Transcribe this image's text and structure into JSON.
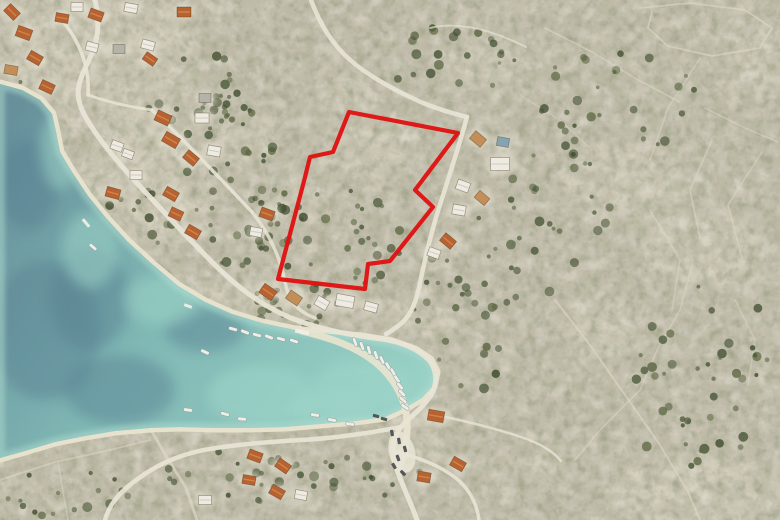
{
  "meta": {
    "description": "Aerial satellite photo of a coastal village and bay with a building plot outlined in red on a scrub hillside",
    "width": 780,
    "height": 520
  },
  "colors": {
    "land_base": "#c5bfae",
    "rock_light": "#d9d3c2",
    "veg_olive": "#6b6a4a",
    "veg_dark": "#3e452b",
    "tree": [
      "#42502f",
      "#55603a",
      "#384626"
    ],
    "sand": "#ece5d0",
    "water_deep": "#52828f",
    "water_mid": "#6fb0ad",
    "water_shallow": "#8fcfc2",
    "water_dark_patch": "#3e6a80",
    "water_light_patch": "#94d4c6",
    "shallow_rim": "#a7dccd",
    "road": "#ebe6d7",
    "wall": "#ded9c7",
    "yard": "#e8e3d3",
    "roof_orange": "#b65a25",
    "roof_orange_hl": "#d28445",
    "roof_tan": "#c08a52",
    "roof_white": "#f0eee5",
    "roof_gray": "#b3b1a8",
    "roof_blue": "#7fa0b2",
    "boat": "#f2f1e9",
    "car_dark": "#3c4046",
    "parcel_red": "#e01212"
  },
  "parcel": {
    "stroke_width": 4.2,
    "points": [
      [
        349,
        112
      ],
      [
        458,
        133
      ],
      [
        415,
        190
      ],
      [
        433,
        207
      ],
      [
        390,
        261
      ],
      [
        368,
        264
      ],
      [
        365,
        289
      ],
      [
        278,
        279
      ],
      [
        303,
        185
      ],
      [
        310,
        157
      ],
      [
        333,
        152
      ]
    ]
  },
  "water": {
    "points": [
      [
        0,
        84
      ],
      [
        22,
        90
      ],
      [
        40,
        100
      ],
      [
        52,
        114
      ],
      [
        56,
        132
      ],
      [
        60,
        152
      ],
      [
        72,
        172
      ],
      [
        88,
        196
      ],
      [
        106,
        218
      ],
      [
        128,
        242
      ],
      [
        152,
        264
      ],
      [
        178,
        286
      ],
      [
        205,
        302
      ],
      [
        232,
        314
      ],
      [
        262,
        323
      ],
      [
        295,
        330
      ],
      [
        330,
        334
      ],
      [
        362,
        337
      ],
      [
        392,
        342
      ],
      [
        415,
        350
      ],
      [
        430,
        360
      ],
      [
        436,
        372
      ],
      [
        433,
        386
      ],
      [
        422,
        398
      ],
      [
        405,
        408
      ],
      [
        385,
        417
      ],
      [
        355,
        421
      ],
      [
        320,
        424
      ],
      [
        285,
        427
      ],
      [
        250,
        428
      ],
      [
        215,
        428
      ],
      [
        180,
        427
      ],
      [
        150,
        428
      ],
      [
        115,
        431
      ],
      [
        85,
        436
      ],
      [
        55,
        442
      ],
      [
        25,
        451
      ],
      [
        0,
        458
      ]
    ],
    "dark_patches": [
      [
        45,
        330,
        55,
        70
      ],
      [
        120,
        390,
        55,
        35
      ],
      [
        28,
        185,
        30,
        45
      ],
      [
        205,
        330,
        40,
        22
      ],
      [
        90,
        300,
        40,
        50
      ]
    ],
    "light_patches": [
      [
        90,
        250,
        28,
        38
      ],
      [
        162,
        300,
        38,
        26
      ],
      [
        360,
        385,
        48,
        26
      ],
      [
        262,
        395,
        55,
        30
      ],
      [
        60,
        150,
        20,
        40
      ],
      [
        330,
        410,
        40,
        18
      ]
    ]
  },
  "roads": [
    {
      "d": "M95,0 C100,24 99,40 88,62 C77,84 74,96 85,116 C96,136 114,158 136,182 C160,208 186,236 212,262 C240,290 263,306 291,318 C321,330 351,335 381,339 C403,342 419,350 429,360 C437,370 438,383 431,395 C423,408 410,417 401,427 C392,438 391,452 396,467 C402,485 411,503 417,520",
      "w": 5,
      "o": 0.95
    },
    {
      "d": "M467,117 C459,146 448,180 438,211 C430,237 424,263 419,288 C415,306 409,318 398,326 C394,329 390,332 386,334",
      "w": 4.5,
      "o": 0.92
    },
    {
      "d": "M311,0 C319,22 331,43 349,59 C369,77 396,91 423,103 C440,110 455,114 467,117",
      "w": 4.5,
      "o": 0.9
    },
    {
      "d": "M401,427 C375,432 340,438 301,440 C266,442 241,444 216,448 C186,452 161,462 139,478 C119,492 109,505 105,520",
      "w": 4.5,
      "o": 0.92
    },
    {
      "d": "M396,452 C418,457 441,466 457,479 C471,491 477,505 479,520",
      "w": 3.5,
      "o": 0.9
    },
    {
      "d": "M431,414 C456,419 491,427 521,437 C539,443 553,451 561,461",
      "w": 2.5,
      "o": 0.8
    },
    {
      "d": "M62,20 C80,42 90,68 88,95",
      "w": 3.5,
      "o": 0.9
    },
    {
      "d": "M88,95 C108,102 130,107 152,110",
      "w": 3,
      "o": 0.85
    },
    {
      "d": "M152,110 C178,134 214,172 252,212",
      "w": 3.5,
      "o": 0.9
    },
    {
      "d": "M252,212 C268,232 280,256 285,282 C288,300 298,312 315,318",
      "w": 3.5,
      "o": 0.85
    },
    {
      "d": "M430,28 C462,20 498,33 526,47",
      "w": 2,
      "o": 0.65
    }
  ],
  "walls": [
    {
      "pts": [
        [
          640,
          8
        ],
        [
          690,
          3
        ],
        [
          745,
          10
        ],
        [
          772,
          28
        ],
        [
          760,
          48
        ],
        [
          712,
          56
        ],
        [
          668,
          46
        ],
        [
          648,
          28
        ],
        [
          652,
          12
        ]
      ],
      "w": 1.8,
      "o": 0.6
    },
    {
      "pts": [
        [
          545,
          28
        ],
        [
          592,
          52
        ],
        [
          638,
          80
        ],
        [
          680,
          102
        ]
      ],
      "w": 1.6,
      "o": 0.55
    },
    {
      "pts": [
        [
          700,
          58
        ],
        [
          668,
          108
        ],
        [
          650,
          160
        ]
      ],
      "w": 1.6,
      "o": 0.5
    },
    {
      "pts": [
        [
          705,
          108
        ],
        [
          745,
          128
        ],
        [
          778,
          142
        ]
      ],
      "w": 1.6,
      "o": 0.5
    },
    {
      "pts": [
        [
          712,
          140
        ],
        [
          690,
          190
        ],
        [
          700,
          238
        ]
      ],
      "w": 1.6,
      "o": 0.5
    },
    {
      "pts": [
        [
          762,
          152
        ],
        [
          728,
          205
        ],
        [
          742,
          258
        ]
      ],
      "w": 1.6,
      "o": 0.5
    },
    {
      "pts": [
        [
          650,
          210
        ],
        [
          680,
          260
        ],
        [
          672,
          310
        ]
      ],
      "w": 1.6,
      "o": 0.45
    },
    {
      "pts": [
        [
          555,
          300
        ],
        [
          590,
          345
        ],
        [
          625,
          395
        ],
        [
          660,
          445
        ],
        [
          688,
          492
        ],
        [
          700,
          520
        ]
      ],
      "w": 2,
      "o": 0.6
    },
    {
      "pts": [
        [
          692,
          266
        ],
        [
          680,
          310
        ],
        [
          658,
          348
        ],
        [
          640,
          390
        ],
        [
          600,
          430
        ],
        [
          575,
          460
        ]
      ],
      "w": 1.6,
      "o": 0.5
    },
    {
      "pts": [
        [
          735,
          300
        ],
        [
          755,
          340
        ],
        [
          748,
          385
        ]
      ],
      "w": 1.6,
      "o": 0.45
    },
    {
      "pts": [
        [
          0,
          480
        ],
        [
          55,
          462
        ],
        [
          110,
          450
        ],
        [
          150,
          440
        ]
      ],
      "w": 1.8,
      "o": 0.55
    },
    {
      "pts": [
        [
          58,
          462
        ],
        [
          68,
          520
        ]
      ],
      "w": 1.6,
      "o": 0.5
    },
    {
      "pts": [
        [
          150,
          428
        ],
        [
          166,
          456
        ],
        [
          186,
          488
        ],
        [
          197,
          520
        ]
      ],
      "w": 3,
      "o": 0.7
    },
    {
      "pts": [
        [
          520,
          95
        ],
        [
          560,
          120
        ],
        [
          592,
          150
        ]
      ],
      "w": 1.4,
      "o": 0.4
    }
  ],
  "rock_patches": [
    [
      370,
      150,
      48,
      30
    ],
    [
      300,
      200,
      36,
      24
    ],
    [
      250,
      140,
      30,
      20
    ],
    [
      480,
      62,
      44,
      26
    ],
    [
      620,
      180,
      60,
      40
    ],
    [
      700,
      250,
      58,
      42
    ],
    [
      552,
      462,
      22,
      12
    ],
    [
      690,
      490,
      85,
      38
    ],
    [
      600,
      330,
      40,
      30
    ],
    [
      760,
      60,
      30,
      40
    ],
    [
      345,
      95,
      30,
      18
    ],
    [
      420,
      320,
      35,
      20
    ],
    [
      90,
      60,
      110,
      70
    ],
    [
      150,
      180,
      70,
      60
    ],
    [
      220,
      300,
      90,
      25
    ],
    [
      400,
      440,
      40,
      45
    ]
  ],
  "tree_clusters": [
    [
      235,
      180,
      55,
      90,
      45,
      1
    ],
    [
      330,
      240,
      72,
      55,
      40,
      2
    ],
    [
      300,
      302,
      60,
      24,
      20,
      3
    ],
    [
      195,
      92,
      55,
      40,
      22,
      4
    ],
    [
      140,
      230,
      45,
      40,
      18,
      5
    ],
    [
      480,
      300,
      80,
      90,
      35,
      6
    ],
    [
      620,
      100,
      85,
      55,
      28,
      7
    ],
    [
      560,
      205,
      60,
      60,
      25,
      8
    ],
    [
      700,
      350,
      70,
      80,
      30,
      9
    ],
    [
      240,
      480,
      80,
      30,
      20,
      10
    ],
    [
      450,
      62,
      65,
      38,
      22,
      11
    ],
    [
      360,
      472,
      60,
      28,
      15,
      12
    ],
    [
      12,
      108,
      20,
      32,
      12,
      13
    ],
    [
      60,
      495,
      70,
      26,
      16,
      14
    ],
    [
      690,
      440,
      60,
      30,
      14,
      15
    ],
    [
      255,
      332,
      40,
      10,
      8,
      16
    ]
  ],
  "houses": [
    [
      12,
      12,
      14,
      10,
      45,
      "O"
    ],
    [
      24,
      33,
      15,
      11,
      20,
      "O"
    ],
    [
      35,
      58,
      14,
      10,
      30,
      "O"
    ],
    [
      11,
      70,
      13,
      9,
      10,
      "T"
    ],
    [
      47,
      87,
      14,
      10,
      25,
      "O"
    ],
    [
      62,
      18,
      13,
      9,
      10,
      "O"
    ],
    [
      77,
      7,
      12,
      9,
      0,
      "W"
    ],
    [
      92,
      47,
      12,
      9,
      15,
      "W"
    ],
    [
      96,
      15,
      14,
      10,
      20,
      "O"
    ],
    [
      131,
      8,
      13,
      9,
      10,
      "W"
    ],
    [
      184,
      12,
      14,
      10,
      0,
      "O"
    ],
    [
      148,
      45,
      13,
      9,
      15,
      "W"
    ],
    [
      119,
      49,
      12,
      9,
      0,
      "G"
    ],
    [
      150,
      59,
      13,
      9,
      35,
      "O"
    ],
    [
      205,
      98,
      12,
      9,
      0,
      "G"
    ],
    [
      163,
      118,
      15,
      11,
      25,
      "O"
    ],
    [
      171,
      140,
      16,
      11,
      30,
      "O"
    ],
    [
      117,
      146,
      12,
      9,
      20,
      "W"
    ],
    [
      128,
      154,
      11,
      8,
      20,
      "W"
    ],
    [
      191,
      158,
      14,
      10,
      40,
      "O"
    ],
    [
      202,
      118,
      14,
      10,
      0,
      "W"
    ],
    [
      214,
      151,
      13,
      10,
      10,
      "W"
    ],
    [
      136,
      175,
      12,
      9,
      0,
      "W"
    ],
    [
      113,
      193,
      14,
      10,
      15,
      "O"
    ],
    [
      171,
      194,
      14,
      10,
      30,
      "O"
    ],
    [
      176,
      214,
      13,
      10,
      25,
      "O"
    ],
    [
      193,
      232,
      14,
      10,
      30,
      "O"
    ],
    [
      267,
      214,
      14,
      10,
      20,
      "O"
    ],
    [
      256,
      232,
      12,
      9,
      10,
      "W"
    ],
    [
      268,
      292,
      15,
      11,
      35,
      "O"
    ],
    [
      294,
      298,
      14,
      10,
      35,
      "T"
    ],
    [
      322,
      303,
      13,
      10,
      30,
      "W"
    ],
    [
      345,
      301,
      18,
      12,
      10,
      "W"
    ],
    [
      371,
      307,
      13,
      9,
      15,
      "W"
    ],
    [
      478,
      139,
      14,
      10,
      40,
      "T"
    ],
    [
      503,
      142,
      12,
      9,
      10,
      "B"
    ],
    [
      500,
      164,
      19,
      13,
      0,
      "W"
    ],
    [
      463,
      186,
      13,
      10,
      20,
      "W"
    ],
    [
      482,
      198,
      13,
      9,
      40,
      "T"
    ],
    [
      459,
      210,
      13,
      10,
      10,
      "W"
    ],
    [
      448,
      241,
      14,
      10,
      40,
      "O"
    ],
    [
      434,
      253,
      12,
      9,
      20,
      "W"
    ],
    [
      436,
      416,
      16,
      11,
      10,
      "O"
    ],
    [
      458,
      464,
      14,
      10,
      30,
      "O"
    ],
    [
      424,
      477,
      13,
      10,
      10,
      "O"
    ],
    [
      255,
      456,
      14,
      10,
      20,
      "O"
    ],
    [
      283,
      466,
      14,
      10,
      35,
      "O"
    ],
    [
      249,
      480,
      13,
      9,
      10,
      "O"
    ],
    [
      277,
      492,
      14,
      10,
      30,
      "O"
    ],
    [
      205,
      500,
      13,
      9,
      0,
      "W"
    ],
    [
      301,
      495,
      12,
      9,
      10,
      "W"
    ]
  ],
  "boats": [
    [
      233,
      329,
      15
    ],
    [
      245,
      332,
      20
    ],
    [
      257,
      335,
      15
    ],
    [
      269,
      337,
      20
    ],
    [
      281,
      339,
      15
    ],
    [
      294,
      341,
      18
    ],
    [
      355,
      342,
      70
    ],
    [
      362,
      346,
      70
    ],
    [
      369,
      350,
      75
    ],
    [
      376,
      355,
      70
    ],
    [
      382,
      360,
      65
    ],
    [
      388,
      366,
      60
    ],
    [
      393,
      372,
      60
    ],
    [
      397,
      379,
      55
    ],
    [
      400,
      386,
      50
    ],
    [
      402,
      393,
      45
    ],
    [
      93,
      247,
      40
    ],
    [
      188,
      410,
      10
    ],
    [
      225,
      414,
      15
    ],
    [
      242,
      419,
      5
    ],
    [
      205,
      352,
      25
    ],
    [
      315,
      415,
      10
    ],
    [
      332,
      420,
      12
    ],
    [
      350,
      424,
      8
    ],
    [
      403,
      400,
      40
    ],
    [
      405,
      407,
      35
    ]
  ],
  "cars": [
    [
      392,
      433,
      80
    ],
    [
      399,
      441,
      80
    ],
    [
      405,
      449,
      75
    ],
    [
      398,
      458,
      70
    ],
    [
      394,
      466,
      60
    ],
    [
      403,
      473,
      45
    ],
    [
      384,
      419,
      15
    ],
    [
      376,
      416,
      15
    ]
  ],
  "docks": [
    [
      86,
      223,
      10,
      3,
      50
    ],
    [
      188,
      306,
      8,
      3,
      20
    ],
    [
      302,
      332,
      14,
      4,
      12
    ]
  ],
  "quay": {
    "d": "M302,331 C330,338 355,346 375,362 C392,376 402,392 406,412 C409,432 405,452 399,468",
    "w": 7
  },
  "parking": {
    "cx": 402,
    "cy": 452,
    "rx": 13,
    "ry": 21,
    "rot": -15
  }
}
